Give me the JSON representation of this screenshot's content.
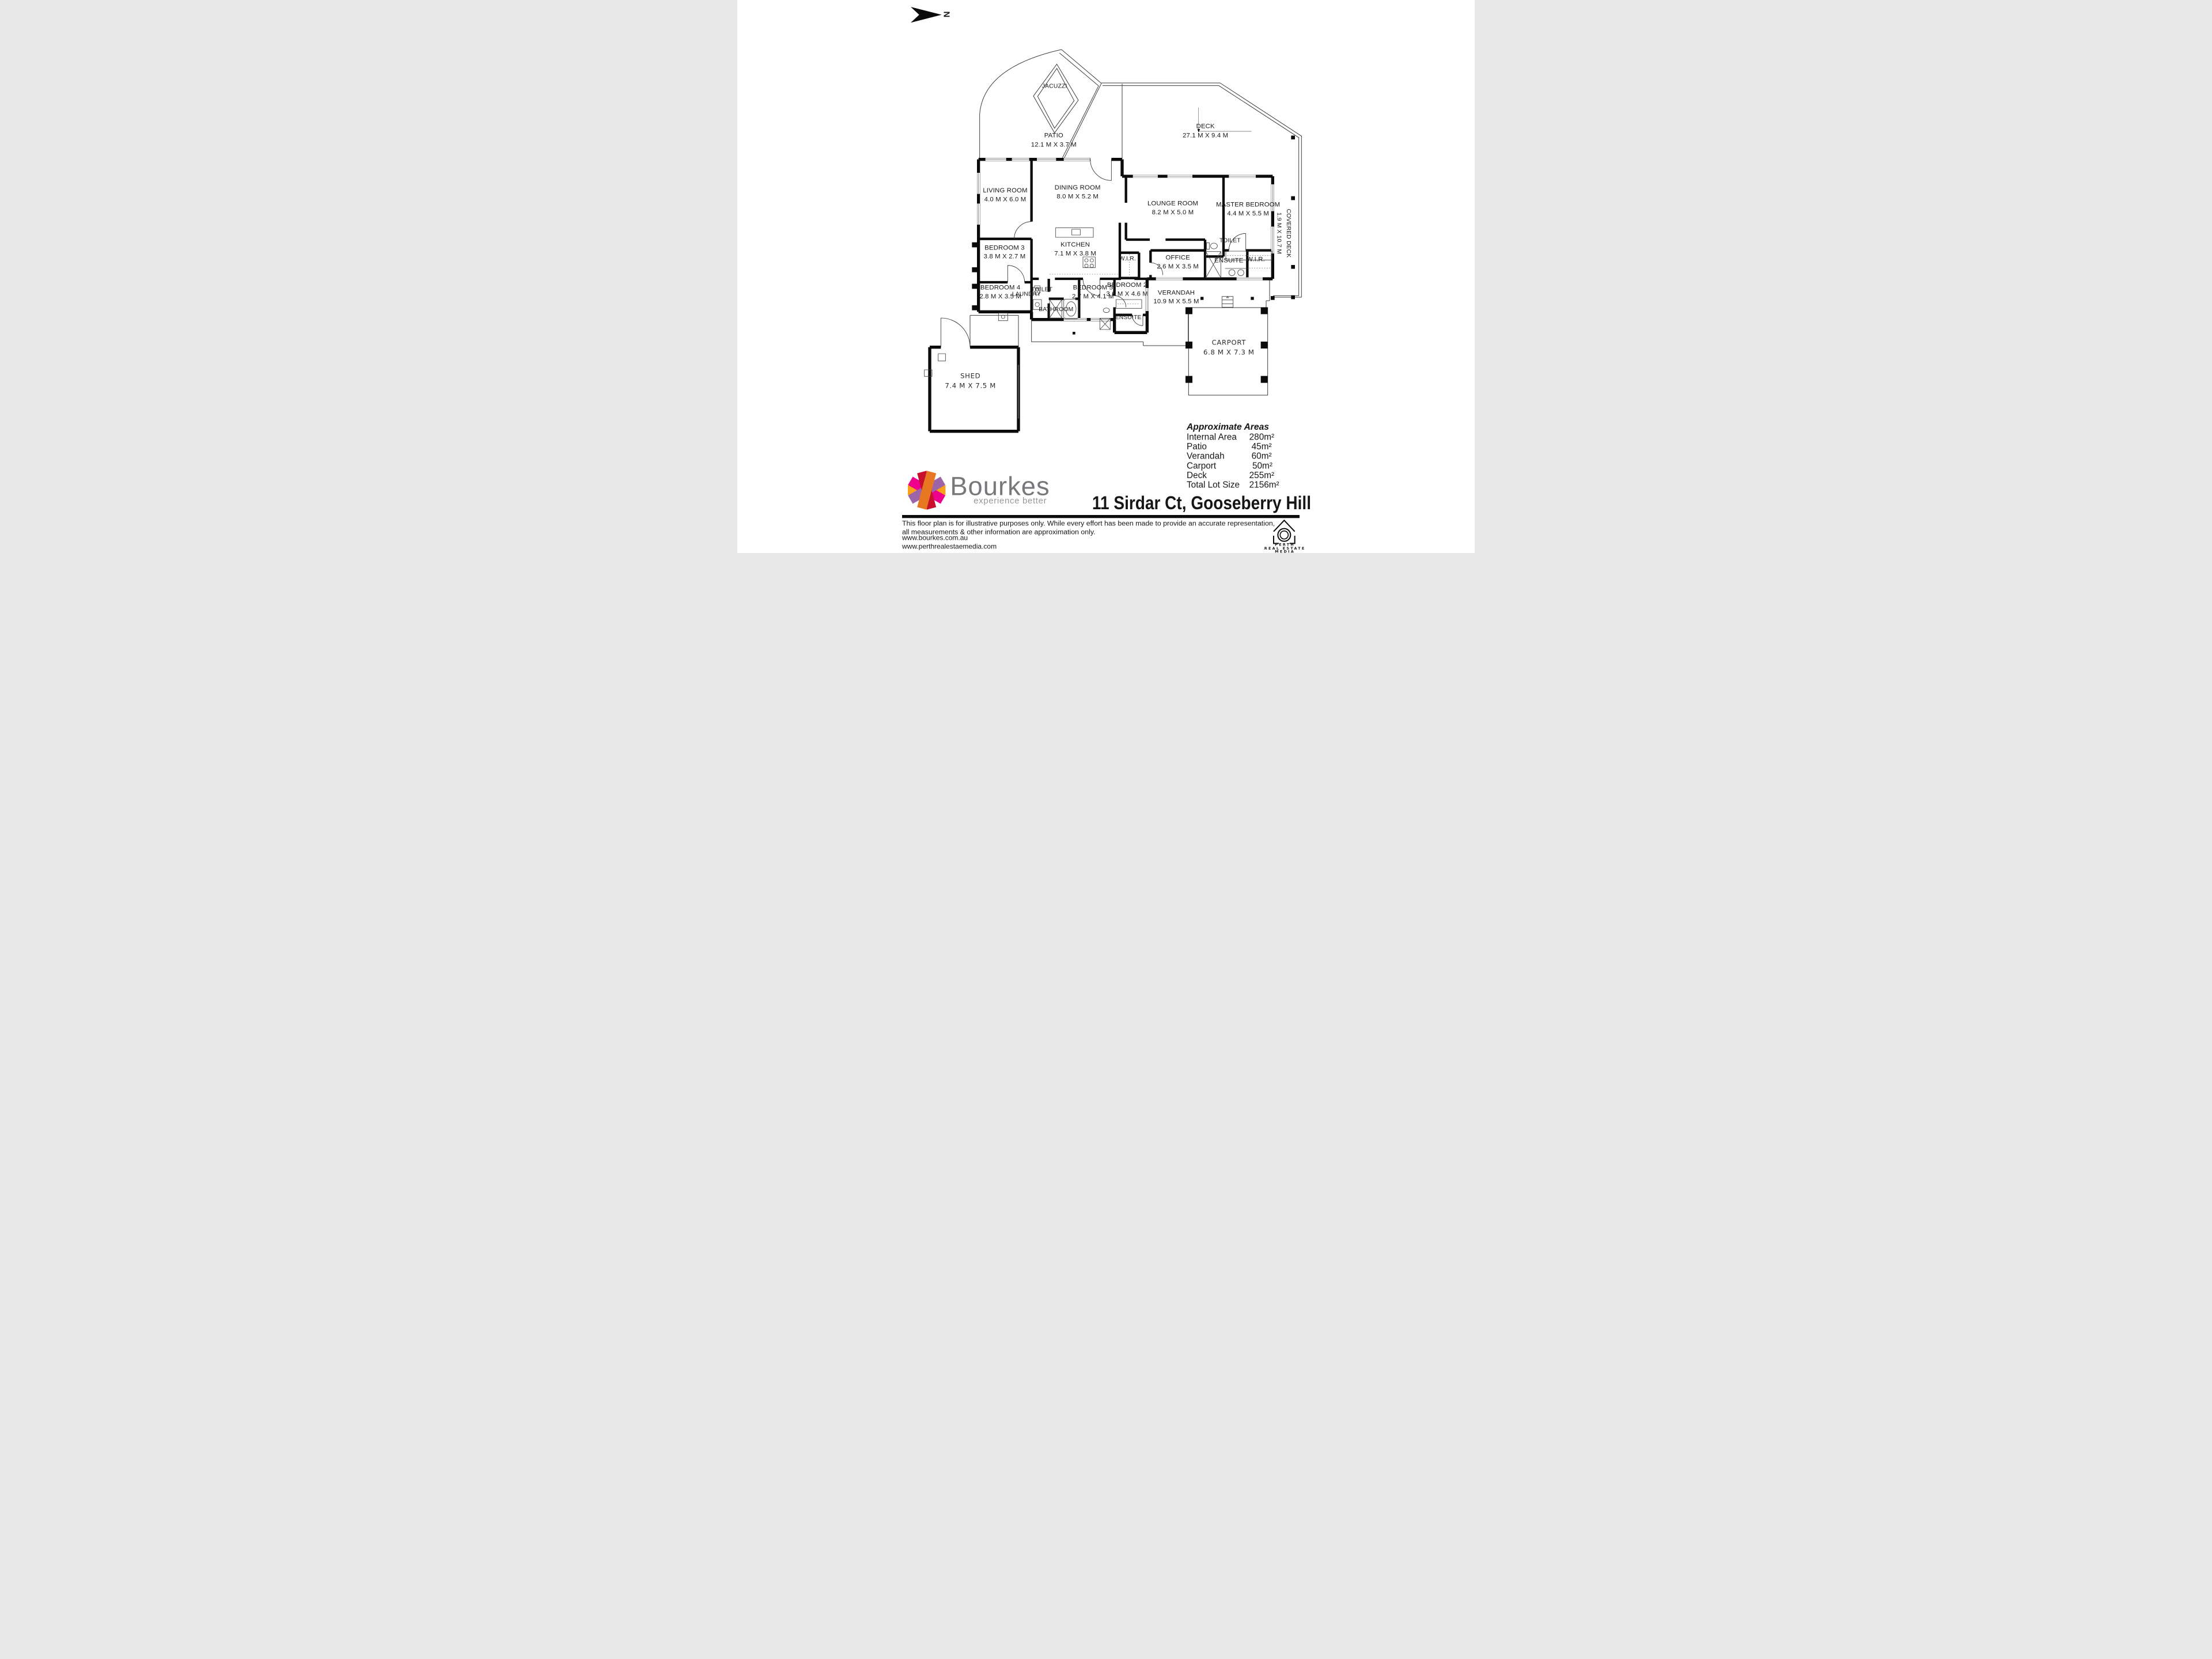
{
  "north_label": "N",
  "rooms": {
    "jacuzzi": {
      "name": "JACUZZI"
    },
    "patio": {
      "name": "PATIO",
      "dims": "12.1 M X 3.7 M"
    },
    "deck": {
      "name": "DECK",
      "dims": "27.1 M X 9.4 M"
    },
    "living": {
      "name": "LIVING ROOM",
      "dims": "4.0 M X 6.0 M"
    },
    "dining": {
      "name": "DINING ROOM",
      "dims": "8.0 M X 5.2 M"
    },
    "lounge": {
      "name": "LOUNGE ROOM",
      "dims": "8.2 M X 5.0 M"
    },
    "master": {
      "name": "MASTER BEDROOM",
      "dims": "4.4 M X 5.5 M"
    },
    "covered_deck": {
      "name": "COVERED DECK",
      "dims": "1.9 M X 10.7 M"
    },
    "bedroom3": {
      "name": "BEDROOM 3",
      "dims": "3.8 M X 2.7 M"
    },
    "kitchen": {
      "name": "KITCHEN",
      "dims": "7.1 M X 3.8 M"
    },
    "wir1": {
      "name": "W.I.R."
    },
    "office": {
      "name": "OFFICE",
      "dims": "2.6 M X 3.5 M"
    },
    "toilet1": {
      "name": "TOILET"
    },
    "ensuite_master": {
      "name": "ENSUITE"
    },
    "wir2": {
      "name": "W.I.R."
    },
    "bedroom4": {
      "name": "BEDROOM 4",
      "dims": "2.8 M X 3.5 M"
    },
    "laundry": {
      "name": "LAUNDRY"
    },
    "toilet2": {
      "name": "TOILET"
    },
    "bathroom": {
      "name": "BATHROOM"
    },
    "bedroom5": {
      "name": "BEDROOM 5",
      "dims": "2.7 M X 4.1 M"
    },
    "bedroom2": {
      "name": "BEDROOM 2",
      "dims": "3.6 M X 4.6 M"
    },
    "ensuite2": {
      "name": "ENSUITE"
    },
    "verandah": {
      "name": "VERANDAH",
      "dims": "10.9 M X 5.5 M"
    },
    "carport": {
      "name": "CARPORT",
      "dims": "6.8 M X 7.3 M"
    },
    "shed": {
      "name": "SHED",
      "dims": "7.4 M X 7.5 M"
    }
  },
  "areas": {
    "title": "Approximate Areas",
    "rows": [
      {
        "label": "Internal Area",
        "value": "280m²"
      },
      {
        "label": "Patio",
        "value": "45m²"
      },
      {
        "label": "Verandah",
        "value": "60m²"
      },
      {
        "label": "Carport",
        "value": "50m²"
      },
      {
        "label": "Deck",
        "value": "255m²"
      },
      {
        "label": "Total Lot Size",
        "value": "2156m²"
      }
    ]
  },
  "brand": {
    "name": "Bourkes",
    "tagline": "experience better"
  },
  "address": "11 Sirdar Ct, Gooseberry Hill",
  "disclaimer": {
    "line1": "This floor plan is for illustrative purposes only. While every effort has been made to provide an accurate representation,",
    "line2": "all measurements & other information are approximation only."
  },
  "links": {
    "site1": "www.bourkes.com.au",
    "site2": "www.perthrealestaemedia.com"
  },
  "media_logo": {
    "line1": "PERTH",
    "line2": "REAL ESTATE",
    "line3": "MEDIA"
  },
  "colors": {
    "star_amber": "#F7A11A",
    "star_magenta": "#EC008C",
    "star_red": "#C8102E",
    "star_orange": "#E87722",
    "star_purple": "#9E64A8",
    "brand_text": "#77787B",
    "wall": "#0B0B0B"
  }
}
